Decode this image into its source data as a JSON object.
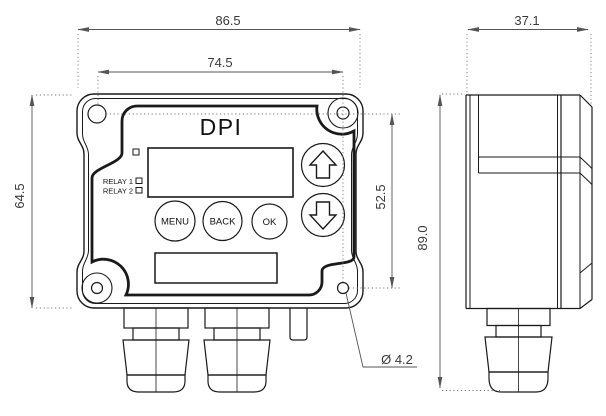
{
  "drawing": {
    "front_view": {
      "title": "DPI",
      "relay1_label": "RELAY 1",
      "relay2_label": "RELAY 2",
      "menu_button": "MENU",
      "back_button": "BACK",
      "ok_button": "OK"
    },
    "dims": {
      "overall_width": "86.5",
      "hole_spacing_horizontal": "74.5",
      "overall_height": "64.5",
      "hole_spacing_vertical": "52.5",
      "side_depth": "37.1",
      "side_height": "89.0",
      "hole_diameter": "Ø 4.2"
    },
    "colors": {
      "line": "#1a1a1a",
      "dimension": "#555555",
      "background": "#ffffff"
    }
  }
}
